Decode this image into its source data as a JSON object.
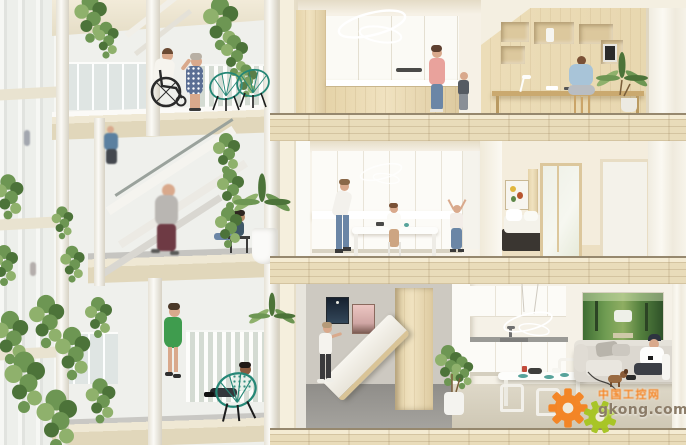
{
  "image": {
    "alt": "Architectural rendering: cross-section of a residential building. Left: exterior balconies with hanging plants and residents (man in wheelchair, woman in floral dress, walkers, seated people in teal wire chairs). Right: three cut-away apartment floors - top: white/wood kitchen and wood study nook with person at desk; middle: white kitchen with family and bedroom; bottom: fold-down murphy bed room, white kitchen with dining table, man on sofa with phone, green park artwork."
  },
  "watermark": {
    "site_name_cn": "中国工控网",
    "site_url": "gkong.com"
  },
  "palette": {
    "cream": "#f2ebdb",
    "slab": "#e9dcba",
    "wood": "#e9d9b4",
    "white": "#fbfaf6",
    "offwhite": "#f1efe8",
    "floorgray": "#9d9b96",
    "wallgray": "#cdc9c1",
    "green1": "#6d9653",
    "green2": "#4c7339",
    "green3": "#8fb16c",
    "teal": "#258776",
    "denim": "#6b86a6",
    "pink": "#e9a29c",
    "skin": "#d9a98c",
    "sofagray": "#dcd8d0",
    "darkart": "#1a2636",
    "wm_orange": "#f5821f",
    "wm_green": "#a6c520",
    "wm_text": "#8b7c68"
  },
  "rooms": {
    "top_left": "kitchen",
    "top_right": "study nook",
    "mid_left": "family kitchen",
    "mid_right": "bedroom",
    "bottom_left": "murphy-bed room",
    "bottom_right": "kitchen / living room"
  }
}
